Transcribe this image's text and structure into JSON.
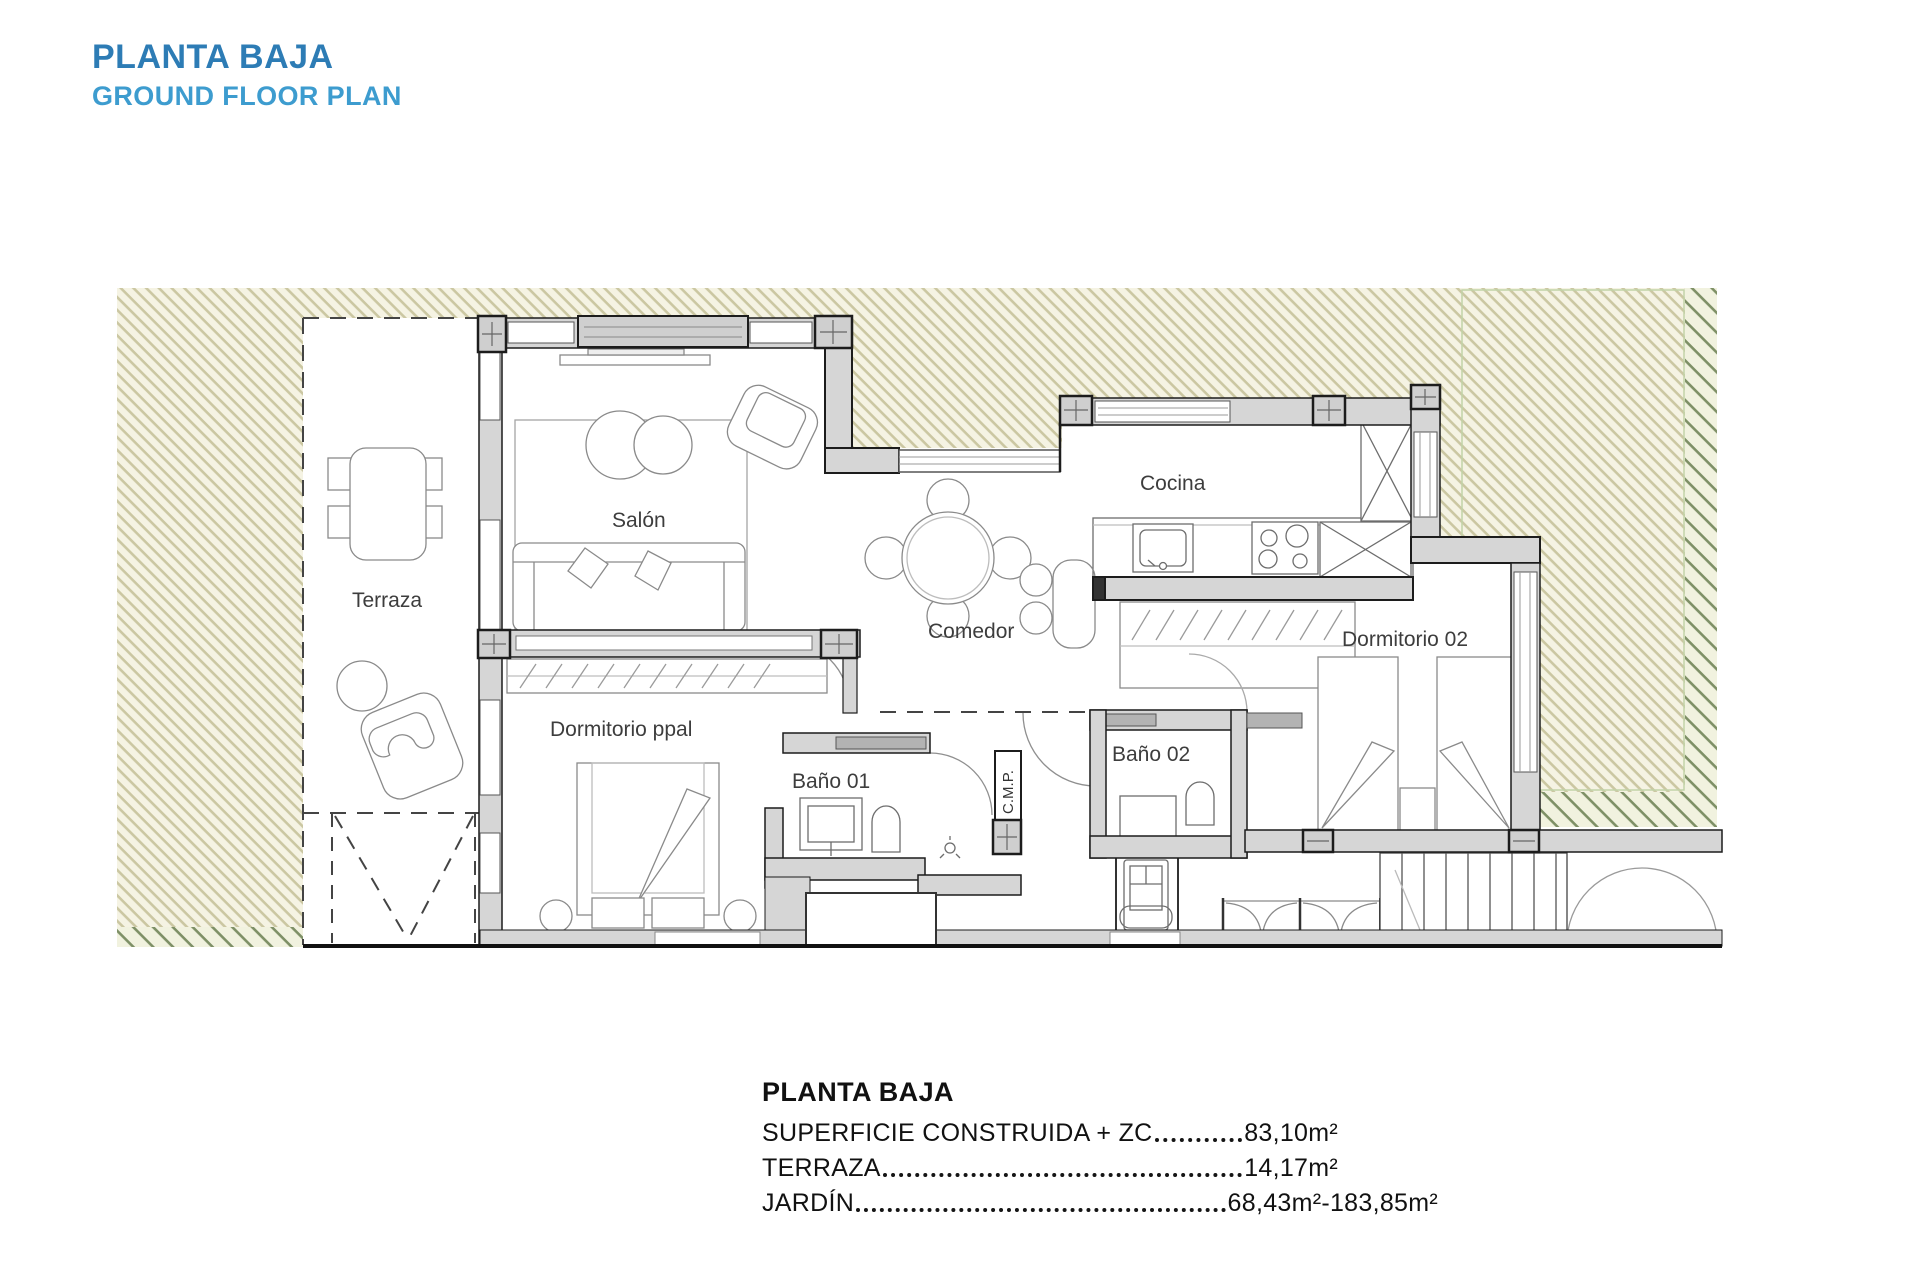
{
  "header": {
    "title_es": "PLANTA BAJA",
    "title_en": "GROUND FLOOR PLAN"
  },
  "plan": {
    "rooms": [
      {
        "label": "Terraza"
      },
      {
        "label": "Salón"
      },
      {
        "label": "Comedor"
      },
      {
        "label": "Cocina"
      },
      {
        "label": "Dormitorio ppal"
      },
      {
        "label": "Baño 01"
      },
      {
        "label": "Baño 02"
      },
      {
        "label": "Dormitorio 02"
      }
    ],
    "shaft_label": "C.M.P."
  },
  "summary": {
    "title": "PLANTA BAJA",
    "rows": [
      {
        "label": "SUPERFICIE CONSTRUIDA + ZC",
        "value": "83,10m²"
      },
      {
        "label": "TERRAZA",
        "value": "14,17m²"
      },
      {
        "label": "JARDÍN",
        "value": "68,43m²-183,85m²"
      }
    ]
  },
  "colors": {
    "title_primary": "#2d7cb5",
    "title_secondary": "#3d9ccf",
    "hatch_line_light": "#cbc7a2",
    "hatch_line_dark": "#7e9066",
    "hatch_bg": "#f5f3e3",
    "wall_fill": "#d6d6d6",
    "wall_outline": "#1c1c1c"
  }
}
